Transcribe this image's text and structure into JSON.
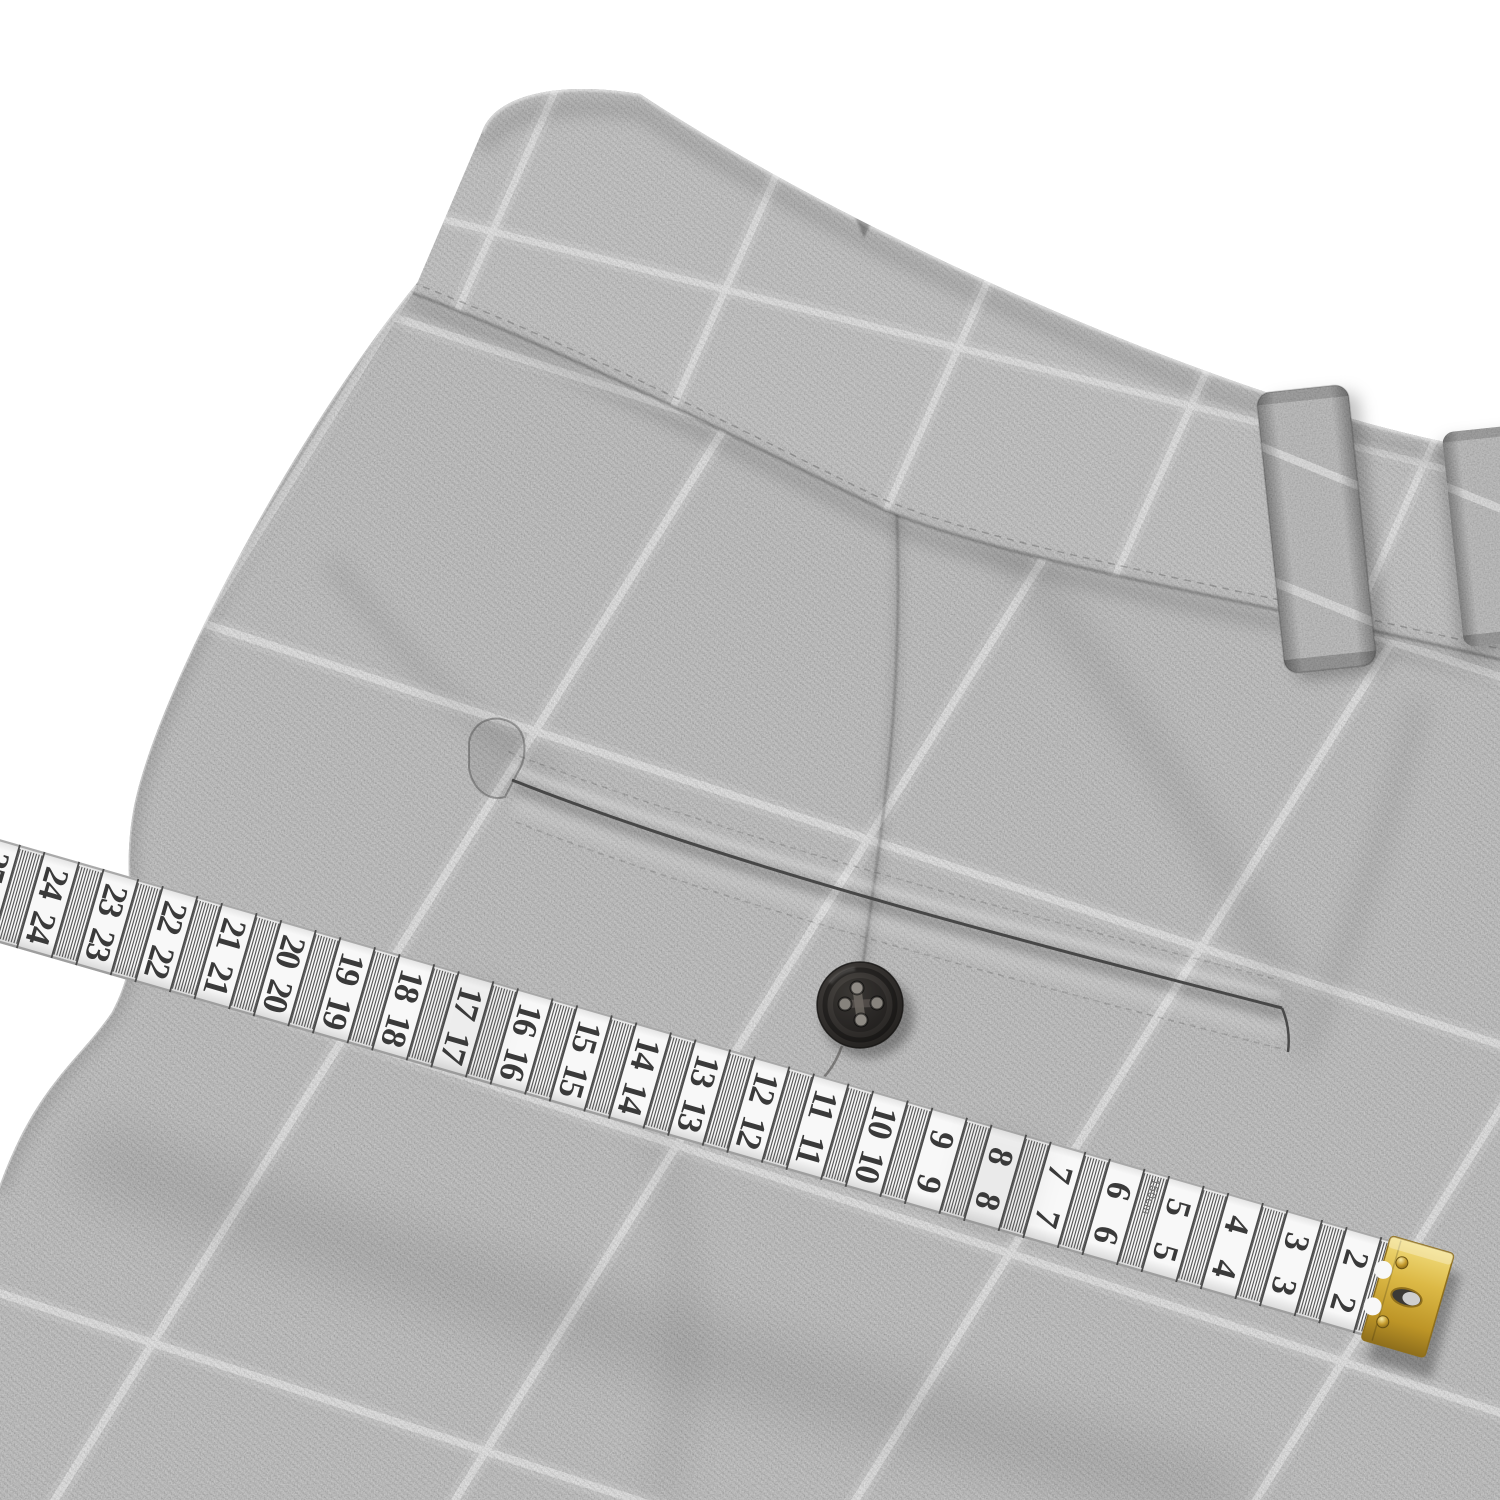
{
  "scene": {
    "background_color": "#ffffff"
  },
  "garment": {
    "fabric_base_color": "#b2b2b2",
    "waistband_base_color": "#b8b8b8",
    "check_line_color": "#ececec",
    "button_color": "#2f2c29",
    "button_hole_count": 4
  },
  "tape": {
    "unit_numbers": [
      25,
      24,
      23,
      22,
      21,
      20,
      19,
      18,
      17,
      16,
      15,
      14,
      13,
      12,
      11,
      10,
      9,
      8,
      7,
      6,
      5,
      4,
      3,
      2
    ],
    "length_label": "150cm",
    "tape_color": "#f8f8f8",
    "digit_color": "#3a3a3a",
    "tick_color": "#585858",
    "cm_line_color": "#4b4b4b",
    "end_clip_color": "#d9b843"
  }
}
